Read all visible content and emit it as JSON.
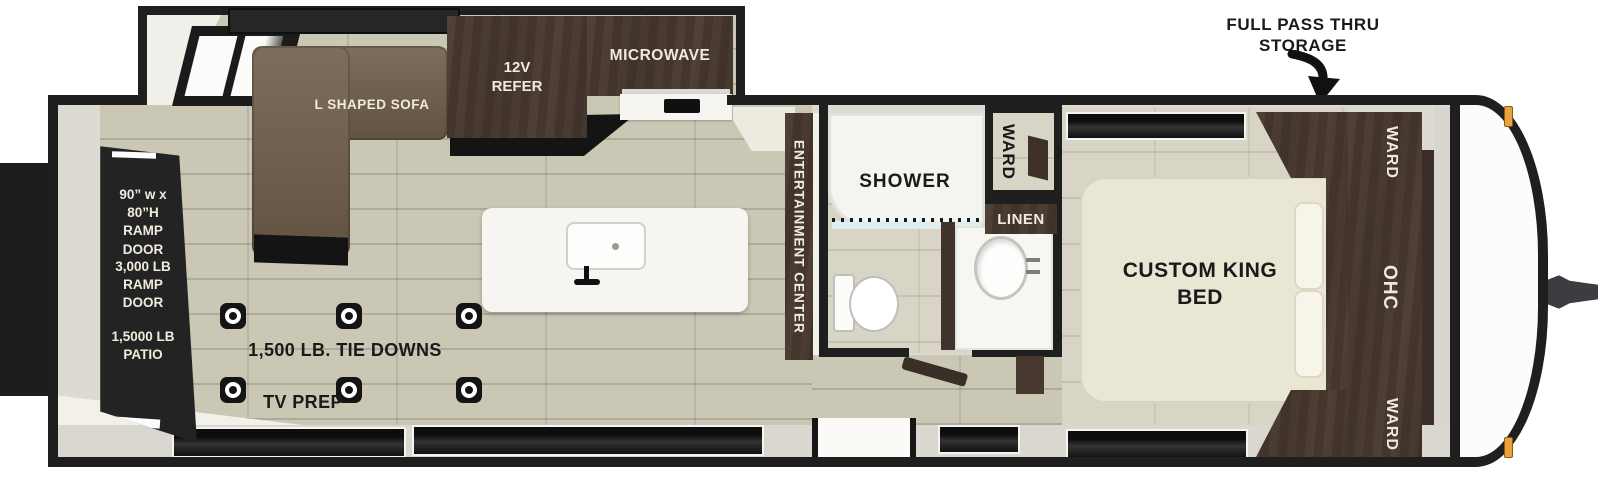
{
  "callout": {
    "line1": "FULL PASS THRU",
    "line2": "STORAGE"
  },
  "rear": {
    "ramp_size": "90” w x 80”H\nRAMP DOOR",
    "ramp_weight": "3,000 LB\nRAMP DOOR",
    "patio": "1,5000 LB\nPATIO"
  },
  "living": {
    "sofa": "L SHAPED SOFA",
    "refer": "12V\nREFER",
    "microwave": "MICROWAVE",
    "tie_downs_label": "1,500 LB. TIE DOWNS",
    "tv_prep": "TV PREP",
    "tie_down_positions": [
      [
        220,
        303
      ],
      [
        336,
        303
      ],
      [
        456,
        303
      ],
      [
        220,
        377
      ],
      [
        336,
        377
      ],
      [
        456,
        377
      ]
    ]
  },
  "entertainment": {
    "label": "ENTERTAINMENT CENTER"
  },
  "bathroom": {
    "shower": "SHOWER",
    "ward": "WARD",
    "linen": "LINEN"
  },
  "bedroom": {
    "bed": "CUSTOM KING\nBED",
    "ward_top": "WARD",
    "ohc": "OHC",
    "ward_bottom": "WARD"
  },
  "colors": {
    "wall": "#1f1f1f",
    "floor_wood": "#cbc7b5",
    "floor_tile": "#d8d4c6",
    "sofa": "#6f5e4a",
    "dark_wood": "#4a3a30",
    "ramp_panel": "#232323",
    "marker_light": "#e8a33c",
    "counter": "#f6f5f1"
  }
}
